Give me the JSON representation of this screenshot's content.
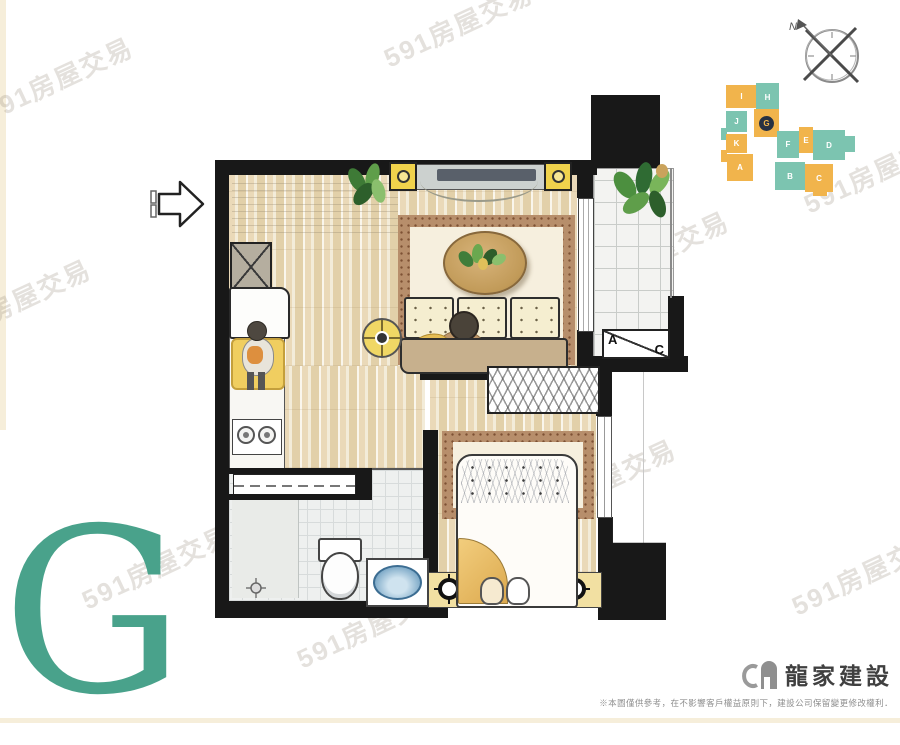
{
  "unit_letter": {
    "label": "G",
    "color": "#49a28b"
  },
  "watermark": {
    "text": "591房屋交易"
  },
  "compass": {
    "north_label": "N"
  },
  "keyplan": {
    "highlight_unit": "G",
    "palette": {
      "orange": "#f1b44c",
      "teal": "#7cc4b0",
      "highlight_ring": "#273142"
    },
    "blocks": [
      {
        "letter": "A",
        "color": "orange"
      },
      {
        "letter": "B",
        "color": "teal"
      },
      {
        "letter": "C",
        "color": "orange"
      },
      {
        "letter": "D",
        "color": "teal"
      },
      {
        "letter": "E",
        "color": "orange"
      },
      {
        "letter": "F",
        "color": "teal"
      },
      {
        "letter": "G",
        "color": "orange",
        "highlighted": true
      },
      {
        "letter": "H",
        "color": "teal"
      },
      {
        "letter": "I",
        "color": "orange"
      },
      {
        "letter": "J",
        "color": "teal"
      },
      {
        "letter": "K",
        "color": "orange"
      }
    ]
  },
  "floorplan": {
    "ac_unit": {
      "label_a": "A",
      "label_c": "C"
    }
  },
  "footer": {
    "company_name": "龍家建設",
    "disclaimer": "※本圖僅供參考，在不影響客戶權益原則下，建設公司保留變更修改權利．"
  }
}
